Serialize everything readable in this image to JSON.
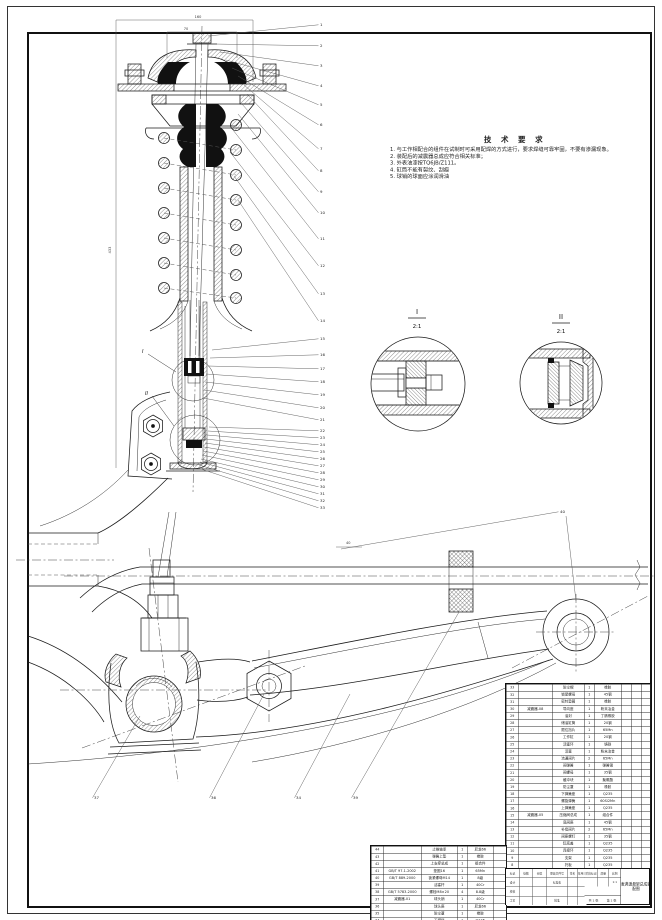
{
  "tech_requirements": {
    "title": "技 术 要 求",
    "items": [
      "1. 与工作相配合的组件在试制时可采用配焊的方式进行，要求焊缝可靠牢固，不要有渗漏现象。",
      "2. 装配后的减震器总成应符合相关标准；",
      "3. 外表油漆按TQ6JB/Z111。",
      "4. 缸筒不能有裂纹、刮痕",
      "5. 球销的球面应涂润滑油"
    ]
  },
  "detail_views": [
    {
      "label": "I",
      "scale": "2:1"
    },
    {
      "label": "II",
      "scale": "2:1"
    }
  ],
  "section_marks": [
    "I",
    "II"
  ],
  "dimensions": {
    "top_width": "160",
    "mount_width": "70",
    "overall_length": "433",
    "stabilizer_offset": "40"
  },
  "callouts": [
    {
      "n": "1",
      "x": 320,
      "y": 26,
      "sx": 208,
      "sy": 36
    },
    {
      "n": "2",
      "x": 320,
      "y": 47,
      "sx": 214,
      "sy": 44
    },
    {
      "n": "3",
      "x": 320,
      "y": 67,
      "sx": 220,
      "sy": 52
    },
    {
      "n": "4",
      "x": 320,
      "y": 87,
      "sx": 226,
      "sy": 60
    },
    {
      "n": "5",
      "x": 320,
      "y": 106,
      "sx": 232,
      "sy": 68
    },
    {
      "n": "6",
      "x": 320,
      "y": 126,
      "sx": 238,
      "sy": 76
    },
    {
      "n": "7",
      "x": 320,
      "y": 150,
      "sx": 244,
      "sy": 85
    },
    {
      "n": "8",
      "x": 320,
      "y": 172,
      "sx": 247,
      "sy": 94
    },
    {
      "n": "9",
      "x": 320,
      "y": 193,
      "sx": 242,
      "sy": 104
    },
    {
      "n": "10",
      "x": 320,
      "y": 214,
      "sx": 238,
      "sy": 114
    },
    {
      "n": "11",
      "x": 320,
      "y": 240,
      "sx": 233,
      "sy": 130
    },
    {
      "n": "12",
      "x": 320,
      "y": 267,
      "sx": 230,
      "sy": 152
    },
    {
      "n": "13",
      "x": 320,
      "y": 295,
      "sx": 234,
      "sy": 176
    },
    {
      "n": "14",
      "x": 320,
      "y": 322,
      "sx": 238,
      "sy": 200
    },
    {
      "n": "15",
      "x": 320,
      "y": 340,
      "sx": 212,
      "sy": 350
    },
    {
      "n": "16",
      "x": 320,
      "y": 356,
      "sx": 210,
      "sy": 358
    },
    {
      "n": "17",
      "x": 320,
      "y": 370,
      "sx": 208,
      "sy": 366
    },
    {
      "n": "18",
      "x": 320,
      "y": 383,
      "sx": 206,
      "sy": 374
    },
    {
      "n": "19",
      "x": 320,
      "y": 396,
      "sx": 205,
      "sy": 382
    },
    {
      "n": "20",
      "x": 320,
      "y": 409,
      "sx": 204,
      "sy": 390
    },
    {
      "n": "21",
      "x": 320,
      "y": 421,
      "sx": 203,
      "sy": 398
    },
    {
      "n": "22",
      "x": 320,
      "y": 432,
      "sx": 209,
      "sy": 427
    },
    {
      "n": "23",
      "x": 320,
      "y": 439,
      "sx": 208,
      "sy": 431
    },
    {
      "n": "24",
      "x": 320,
      "y": 446,
      "sx": 207,
      "sy": 435
    },
    {
      "n": "25",
      "x": 320,
      "y": 453,
      "sx": 206,
      "sy": 439
    },
    {
      "n": "26",
      "x": 320,
      "y": 460,
      "sx": 205,
      "sy": 443
    },
    {
      "n": "27",
      "x": 320,
      "y": 467,
      "sx": 204,
      "sy": 447
    },
    {
      "n": "28",
      "x": 320,
      "y": 474,
      "sx": 203,
      "sy": 451
    },
    {
      "n": "29",
      "x": 320,
      "y": 481,
      "sx": 202,
      "sy": 455
    },
    {
      "n": "30",
      "x": 320,
      "y": 488,
      "sx": 201,
      "sy": 459
    },
    {
      "n": "31",
      "x": 320,
      "y": 495,
      "sx": 200,
      "sy": 462
    },
    {
      "n": "32",
      "x": 320,
      "y": 502,
      "sx": 199,
      "sy": 465
    },
    {
      "n": "33",
      "x": 320,
      "y": 509,
      "sx": 198,
      "sy": 468
    },
    {
      "n": "37",
      "x": 94,
      "y": 799,
      "sx": 140,
      "sy": 716
    },
    {
      "n": "36",
      "x": 211,
      "y": 799,
      "sx": 264,
      "sy": 694
    },
    {
      "n": "34",
      "x": 296,
      "y": 799,
      "sx": 350,
      "sy": 694
    },
    {
      "n": "39",
      "x": 353,
      "y": 799,
      "sx": 459,
      "sy": 612
    },
    {
      "n": "40",
      "x": 560,
      "y": 513,
      "sx": 341,
      "sy": 549
    }
  ],
  "bom_right": {
    "rows": [
      [
        "33",
        "",
        "防尘帽",
        "1",
        "橡胶"
      ],
      [
        "32",
        "",
        "锁紧螺母",
        "1",
        "45钢"
      ],
      [
        "31",
        "",
        "密封垫圈",
        "1",
        "橡胶"
      ],
      [
        "30",
        "减震器-08",
        "导向座",
        "1",
        "粉末冶金"
      ],
      [
        "29",
        "",
        "油封",
        "1",
        "丁腈橡胶"
      ],
      [
        "28",
        "",
        "储油缸筒",
        "1",
        "20钢"
      ],
      [
        "27",
        "",
        "限位挡片",
        "1",
        "65Mn"
      ],
      [
        "26",
        "",
        "工作缸",
        "1",
        "20钢"
      ],
      [
        "25",
        "",
        "活塞环",
        "1",
        "铸铁"
      ],
      [
        "24",
        "",
        "活塞",
        "1",
        "粉末冶金"
      ],
      [
        "23",
        "",
        "流通阀片",
        "2",
        "65Mn"
      ],
      [
        "22",
        "",
        "阀弹簧",
        "1",
        "弹簧钢"
      ],
      [
        "21",
        "",
        "阀螺母",
        "1",
        "35钢"
      ],
      [
        "20",
        "",
        "缓冲块",
        "1",
        "聚氨酯"
      ],
      [
        "19",
        "",
        "防尘罩",
        "1",
        "橡胶"
      ],
      [
        "18",
        "",
        "下弹簧座",
        "1",
        "Q235"
      ],
      [
        "17",
        "",
        "螺旋弹簧",
        "1",
        "60Si2Mn"
      ],
      [
        "16",
        "",
        "上弹簧座",
        "1",
        "Q235"
      ],
      [
        "15",
        "减震器-05",
        "压缩阀总成",
        "1",
        "组合件"
      ],
      [
        "14",
        "",
        "底阀座",
        "1",
        "45钢"
      ],
      [
        "13",
        "",
        "补偿阀片",
        "2",
        "65Mn"
      ],
      [
        "12",
        "",
        "阀座螺钉",
        "1",
        "35钢"
      ],
      [
        "11",
        "",
        "缸底盖",
        "1",
        "Q235"
      ],
      [
        "10",
        "",
        "连接环",
        "1",
        "Q235"
      ],
      [
        "9",
        "",
        "支架",
        "1",
        "Q235"
      ],
      [
        "8",
        "",
        "托板",
        "1",
        "Q235"
      ]
    ]
  },
  "bom_left": {
    "rows": [
      [
        "44",
        "",
        "止推轴承",
        "1",
        "尼龙66"
      ],
      [
        "43",
        "",
        "弹簧上垫",
        "1",
        "橡胶"
      ],
      [
        "42",
        "",
        "上支撑总成",
        "1",
        "组合件"
      ],
      [
        "41",
        "GB/T 97.1-2002",
        "垫圈16",
        "1",
        "65Mn"
      ],
      [
        "40",
        "GB/T 889-2000",
        "锁紧螺母M14",
        "1",
        "8级"
      ],
      [
        "39",
        "",
        "活塞杆",
        "1",
        "40Cr"
      ],
      [
        "38",
        "GB/T 5783-2000",
        "螺栓M8×20",
        "4",
        "8.8级"
      ],
      [
        "37",
        "减震器-01",
        "球头销",
        "1",
        "40Cr"
      ],
      [
        "36",
        "",
        "球头座",
        "1",
        "尼龙66"
      ],
      [
        "35",
        "",
        "防尘罩",
        "1",
        "橡胶"
      ],
      [
        "34",
        "",
        "下摆臂",
        "1",
        "Q345"
      ]
    ]
  },
  "title_block": {
    "sign_cells": [
      "标记",
      "处数",
      "分区",
      "更改文件号",
      "签名",
      "年月日",
      "设计",
      "",
      "",
      "标准化",
      "",
      "",
      "校核",
      "",
      "",
      "",
      "",
      "",
      "工艺",
      "",
      "",
      "批准",
      "",
      ""
    ],
    "stage_label": "阶段标记",
    "mass_label": "质量",
    "scale_label": "比例",
    "scale_value": "1:1",
    "sheets": "共 1 张",
    "sheet_no": "第 1 张",
    "title": "麦弗逊悬架总成装配图"
  }
}
